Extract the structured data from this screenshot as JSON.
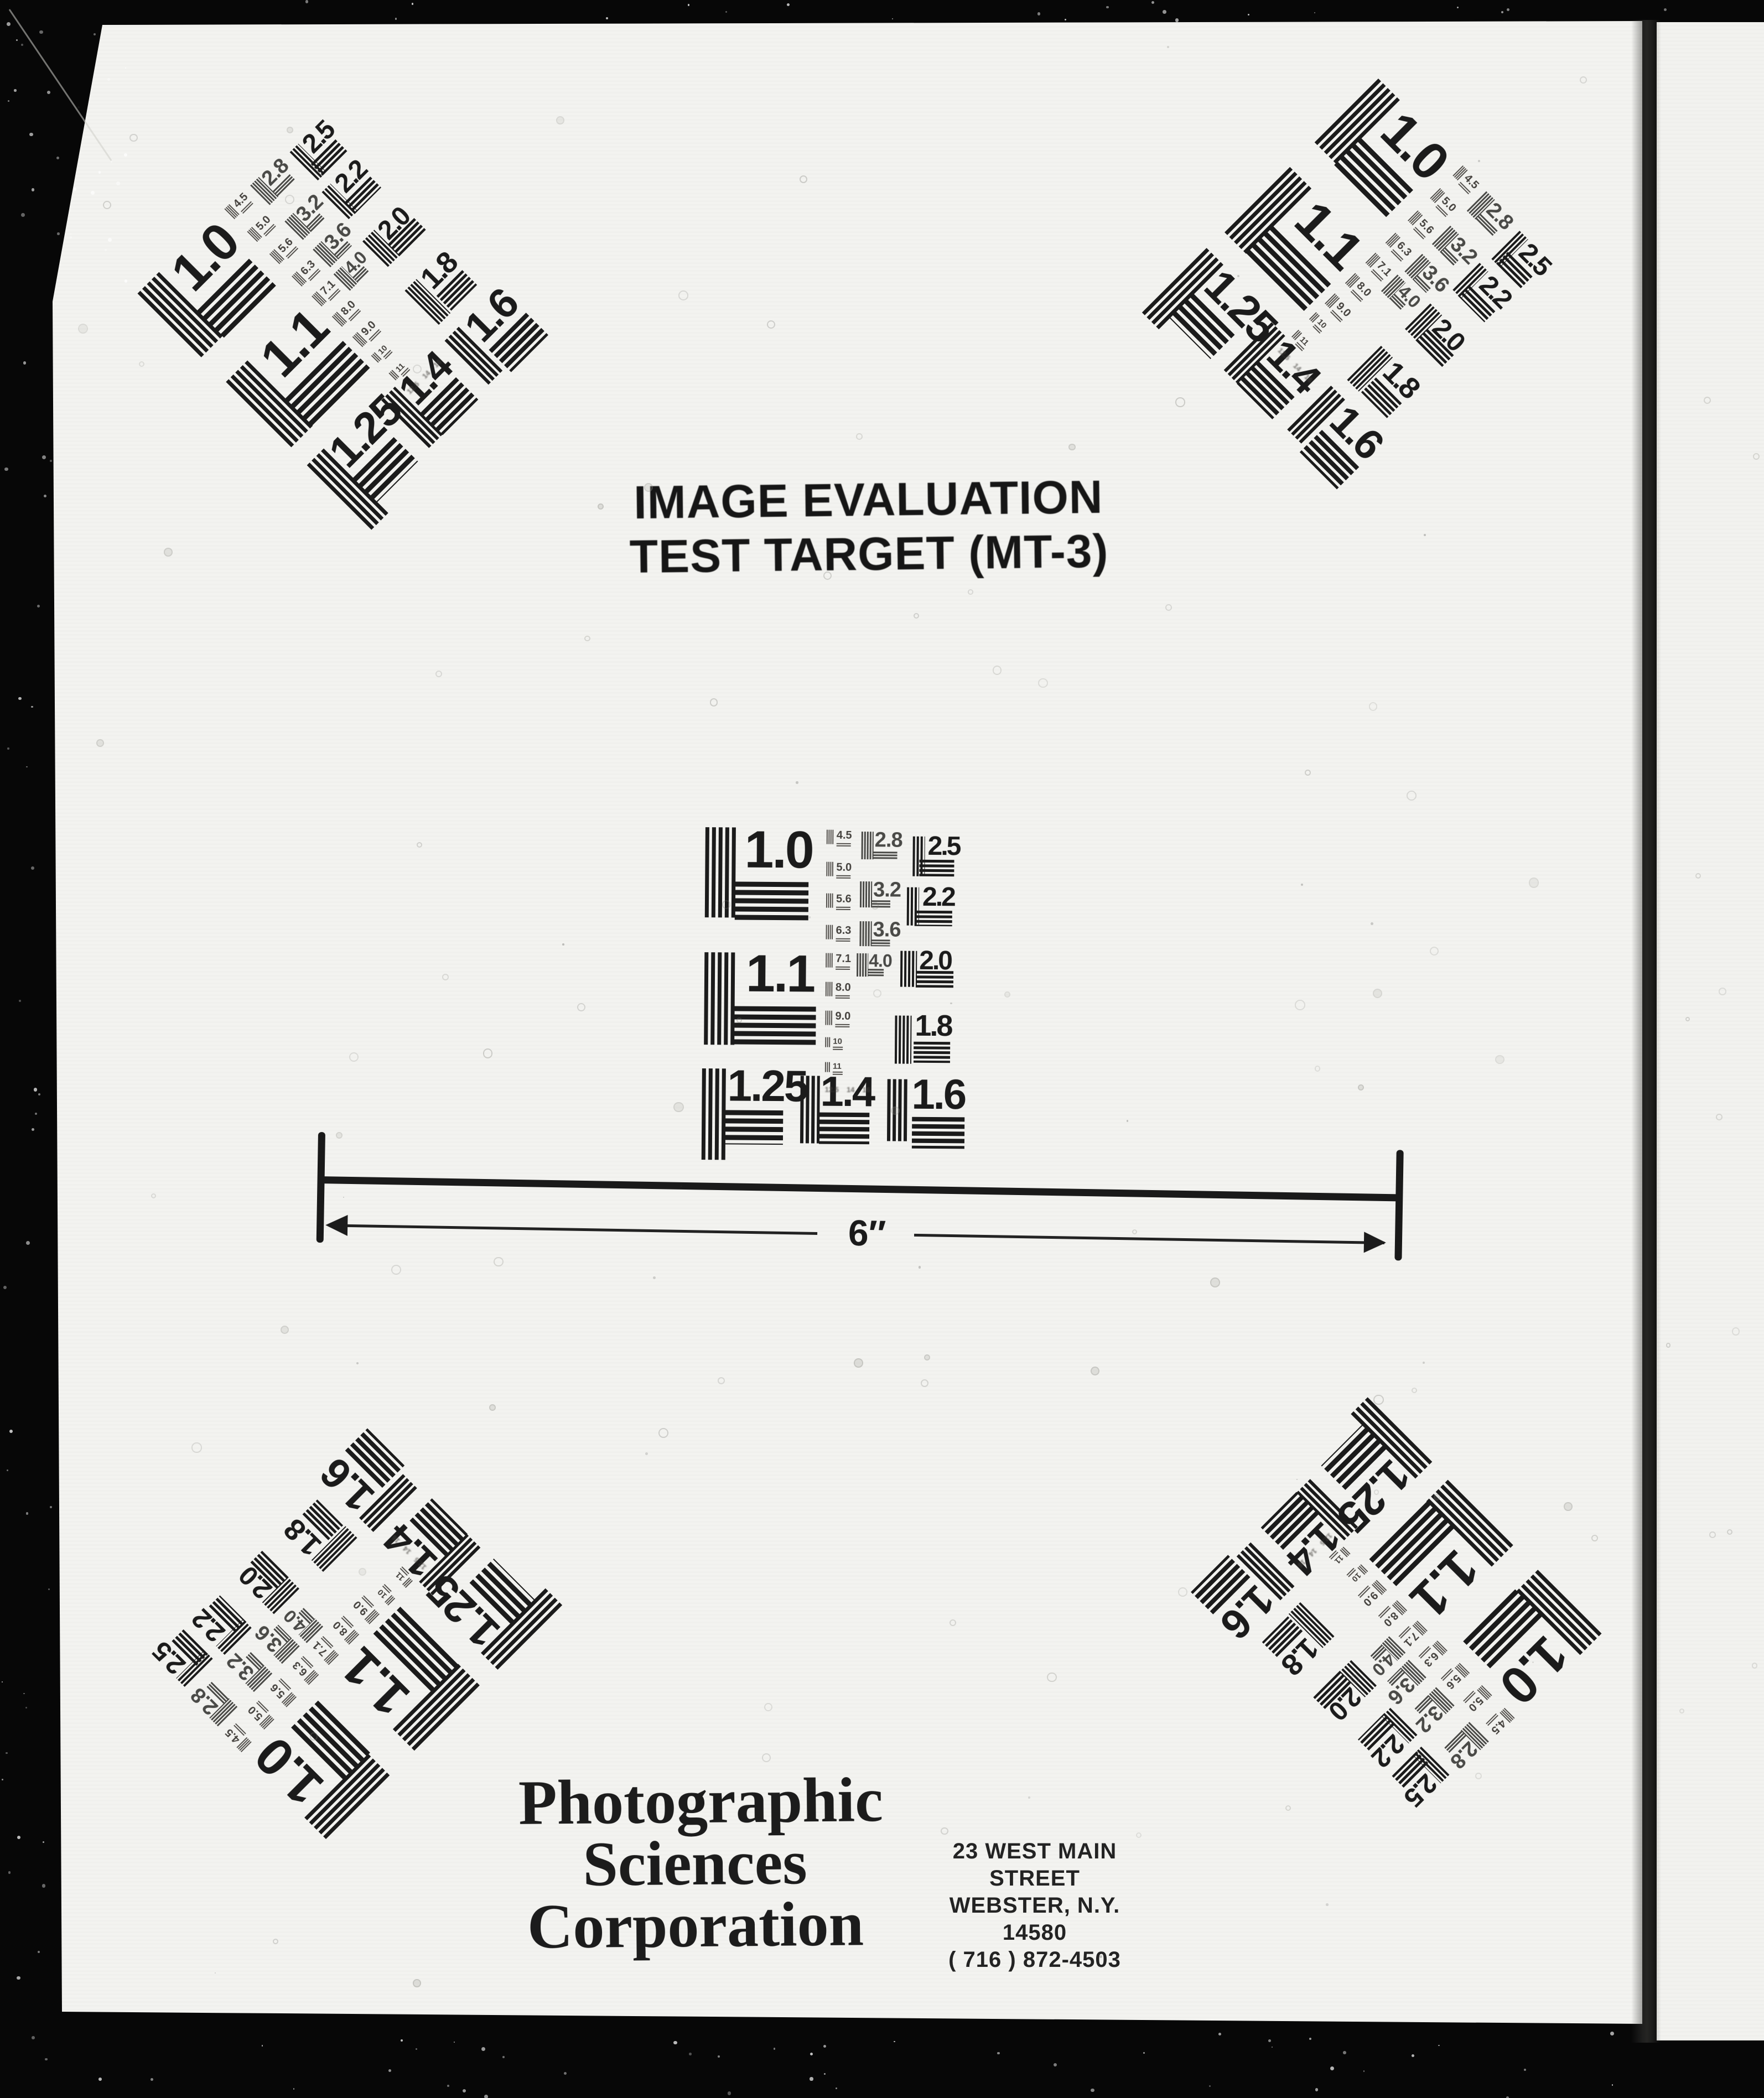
{
  "document": {
    "title_line1": "IMAGE EVALUATION",
    "title_line2": "TEST TARGET (MT-3)",
    "scale_label": "6″",
    "company_lines": [
      "Photographic",
      "Sciences",
      "Corporation"
    ],
    "address_lines": [
      "23 WEST MAIN STREET",
      "WEBSTER, N.Y. 14580",
      "( 716 ) 872-4503"
    ]
  },
  "target": {
    "groups": [
      {
        "label": "1.0"
      },
      {
        "label": "1.1"
      },
      {
        "label": "1.25"
      },
      {
        "label": "1.4"
      },
      {
        "label": "1.6"
      },
      {
        "label": "1.8"
      },
      {
        "label": "2.0"
      },
      {
        "label": "2.2"
      },
      {
        "label": "2.5"
      },
      {
        "label": "2.8"
      },
      {
        "label": "3.2"
      },
      {
        "label": "3.6"
      },
      {
        "label": "4.0"
      }
    ],
    "ladder": [
      "4.5",
      "5.0",
      "5.6",
      "6.3",
      "7.1",
      "8.0",
      "9.0",
      "10",
      "11"
    ],
    "ladder_tiny": [
      "12.5",
      "14",
      "16"
    ]
  }
}
